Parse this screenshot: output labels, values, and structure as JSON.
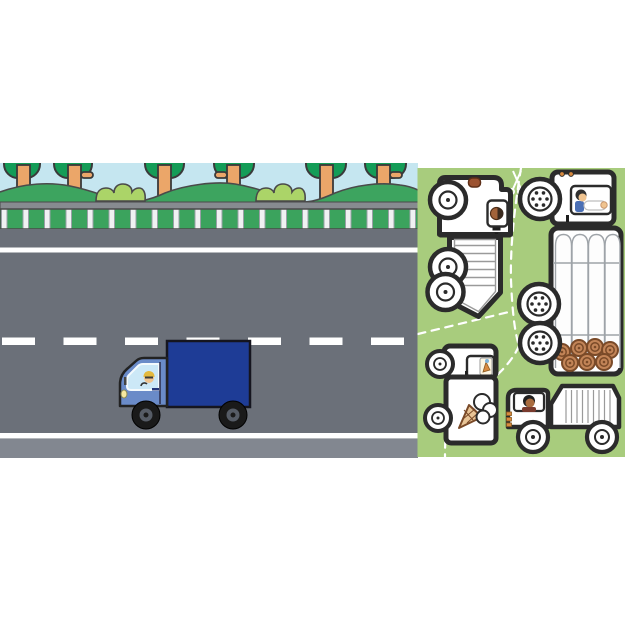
{
  "page": {
    "kind": "children-book-illustration",
    "description": "highway scene with blue box truck beside a green sheet of white truck stickers"
  },
  "palette": {
    "page_white": "#FFFFFF",
    "sky": "#C5E6F0",
    "canopy_green": "#149C57",
    "trunk_orange": "#EBA669",
    "hill_green": "#3DA45F",
    "bush_green": "#ABD468",
    "strip_gray": "#878B90",
    "wall_green": "#3BA35D",
    "post_white": "#F0F1F2",
    "road_gray": "#6B7079",
    "shoulder_gray": "#828790",
    "lane_white": "#FFFFFF",
    "panel_green": "#A8CC7D",
    "outline_dark": "#2B2B2B",
    "sticker_white": "#FFFFFF",
    "cab_blue": "#6A8BC8",
    "box_navy": "#1E3C96",
    "window_blue": "#CCE8F7",
    "tire_black": "#1A1A1A",
    "hub_gray": "#565C66",
    "headlight_yellow": "#F6E9A0",
    "skin": "#F0C490",
    "cap_yellow": "#E3B93F",
    "log_brown": "#C28457",
    "log_line_brown": "#7A4A28",
    "accent_orange": "#D98A3F",
    "cut_line_white": "#FFFFFF"
  },
  "scene": {
    "name": "highway-scene",
    "tree_count": 6,
    "bush_count": 2,
    "elements": [
      "sky",
      "trees",
      "bushes",
      "hills",
      "overpass-strip",
      "guardrail",
      "road",
      "lane-markings",
      "box-truck"
    ],
    "truck": {
      "type": "box-truck",
      "facing": "left",
      "cab_color": "#6A8BC8",
      "box_color": "#1E3C96",
      "driver": "driver-in-yellow-cap"
    }
  },
  "sticker_panel": {
    "name": "truck-sticker-sheet",
    "background": "#A8CC7D",
    "cut_line_style": "white-dashed",
    "scissors_icon": "scissors",
    "stickers": [
      {
        "name": "tipper-truck",
        "orientation": "rotated-90",
        "wheels": 3,
        "details": [
          "ribbed-pointed-bed",
          "driver-window",
          "brown-roof-handle"
        ]
      },
      {
        "name": "log-truck",
        "orientation": "rotated-90",
        "wheels": 3,
        "details": [
          "log-stack",
          "brown-log-ends",
          "driver-window",
          "orange-marker-lights"
        ]
      },
      {
        "name": "ice-cream-truck",
        "orientation": "rotated-90",
        "wheels": 2,
        "details": [
          "ice-cream-cone-art",
          "window-sticker"
        ]
      },
      {
        "name": "dump-truck",
        "orientation": "horizontal-facing-left",
        "wheels": 2,
        "details": [
          "ribbed-dump-bed",
          "driver",
          "orange-front-reflectors"
        ]
      }
    ]
  }
}
